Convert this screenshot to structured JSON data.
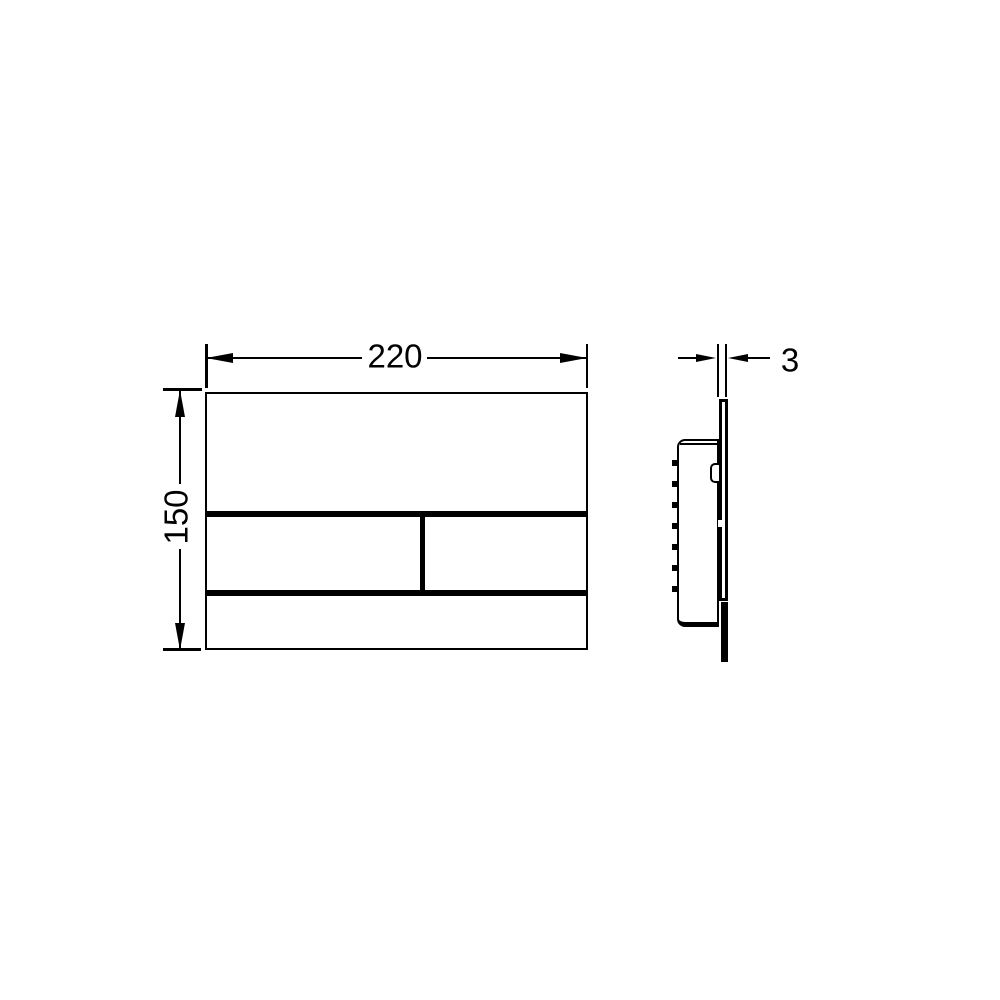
{
  "drawing": {
    "dimensions": {
      "width_mm": "220",
      "height_mm": "150",
      "thickness_mm": "3"
    },
    "colors": {
      "line": "#000000",
      "background": "#ffffff"
    }
  }
}
